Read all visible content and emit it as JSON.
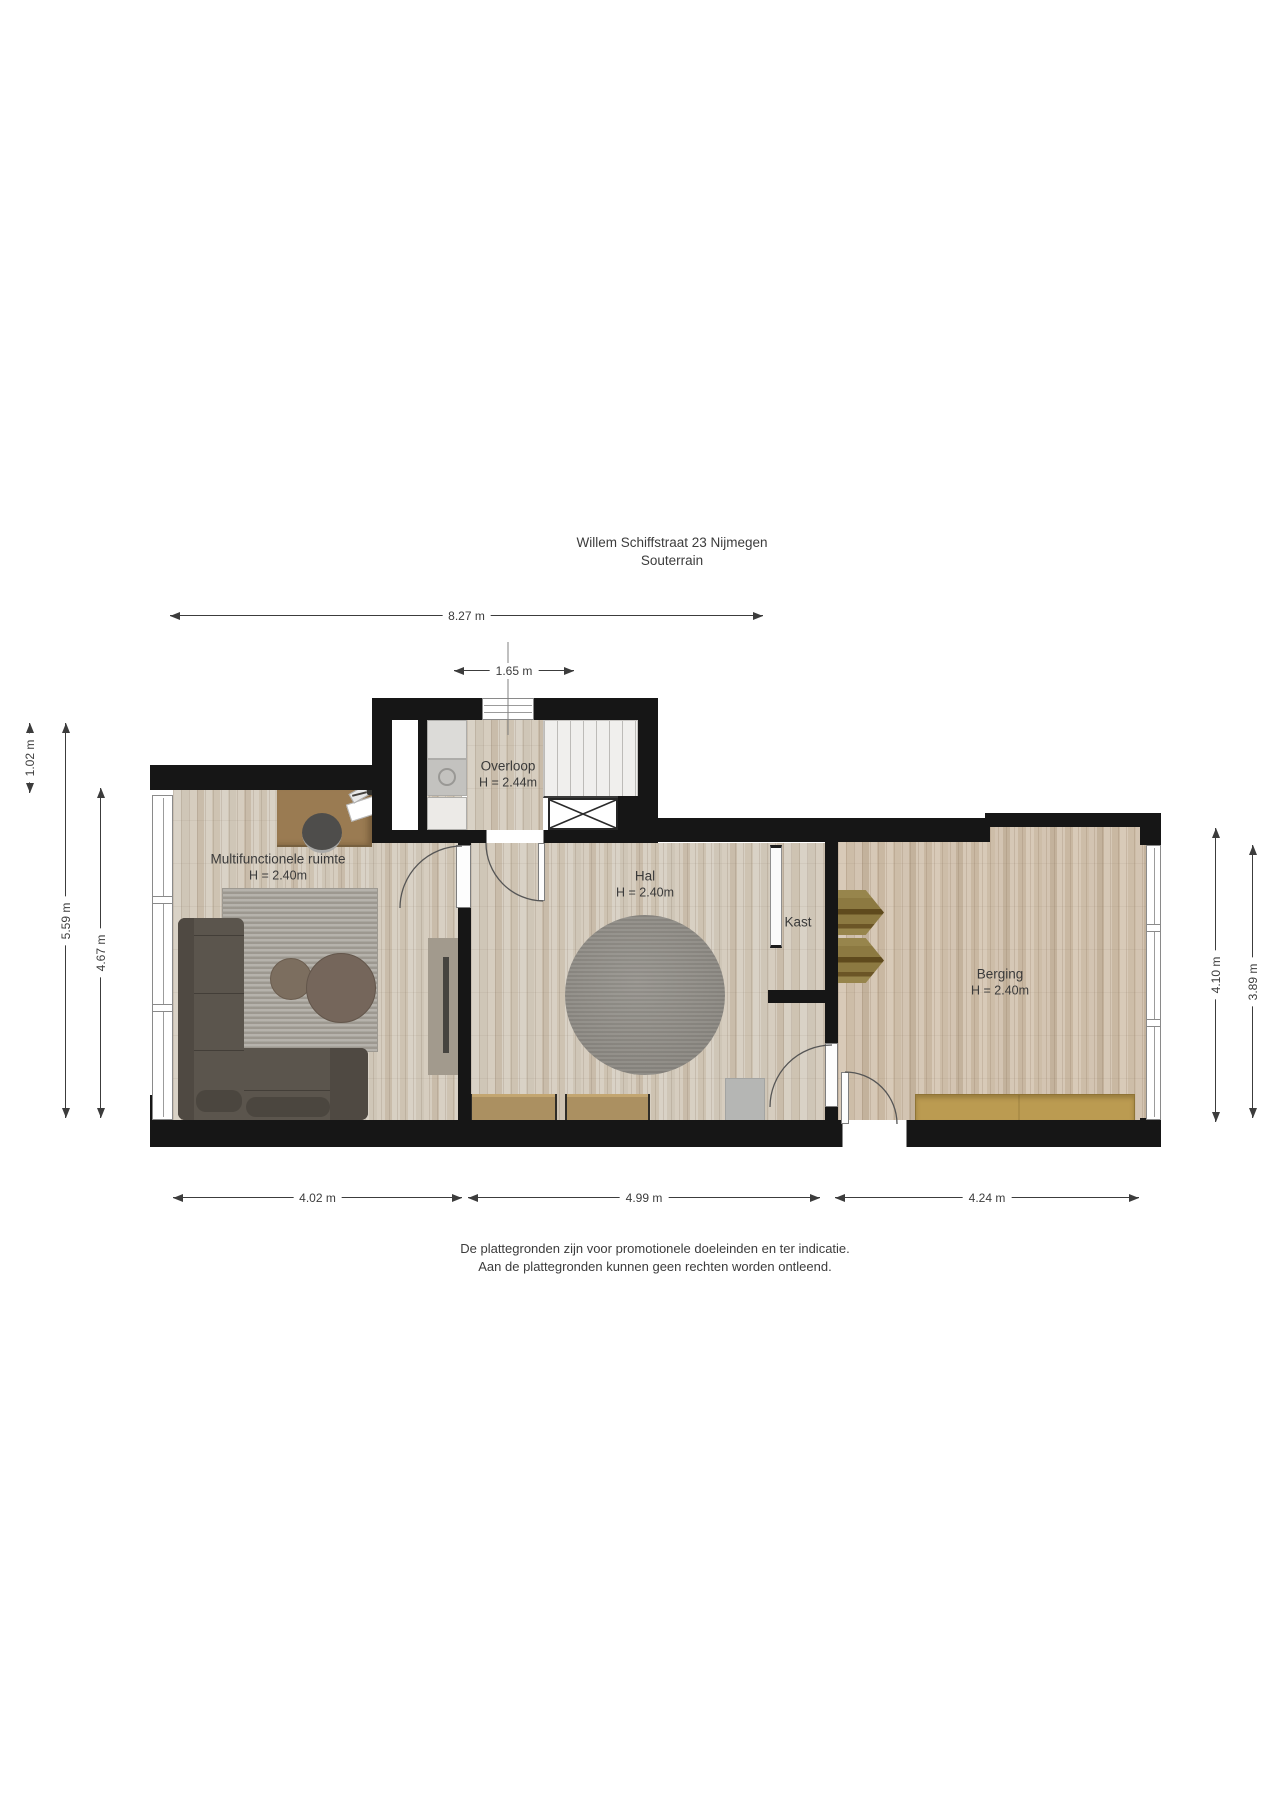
{
  "title": {
    "line1": "Willem Schiffstraat 23 Nijmegen",
    "line2": "Souterrain"
  },
  "rooms": {
    "overloop": {
      "name": "Overloop",
      "height": "H = 2.44m"
    },
    "multifunctionele_ruimte": {
      "name": "Multifunctionele ruimte",
      "height": "H = 2.40m"
    },
    "hal": {
      "name": "Hal",
      "height": "H = 2.40m"
    },
    "kast": {
      "name": "Kast"
    },
    "berging": {
      "name": "Berging",
      "height": "H = 2.40m"
    }
  },
  "dimensions": {
    "top_total": "8.27 m",
    "top_entry": "1.65 m",
    "left_offset": "1.02 m",
    "left_total": "5.59 m",
    "left_room": "4.67 m",
    "right_total": "4.10 m",
    "right_room": "3.89 m",
    "bottom_left": "4.02 m",
    "bottom_middle": "4.99 m",
    "bottom_right": "4.24 m"
  },
  "footer": {
    "line1": "De plattegronden zijn voor promotionele doeleinden en ter indicatie.",
    "line2": "Aan de plattegronden kunnen geen rechten worden ontleend."
  },
  "colors": {
    "wall": "#161616",
    "dimension_text": "#3c3c3c",
    "floor_light": "#d5cdc0",
    "floor_warm": "#d0c2b1",
    "sofa": "#5b554d",
    "rug": "#a8a49c",
    "round_rug": "#8f8d86",
    "desk_wood": "#9a7b52",
    "bench_wood": "#ab9061",
    "sideboard_wood": "#bb9b51",
    "shelf_olive": "#8c7a41"
  }
}
